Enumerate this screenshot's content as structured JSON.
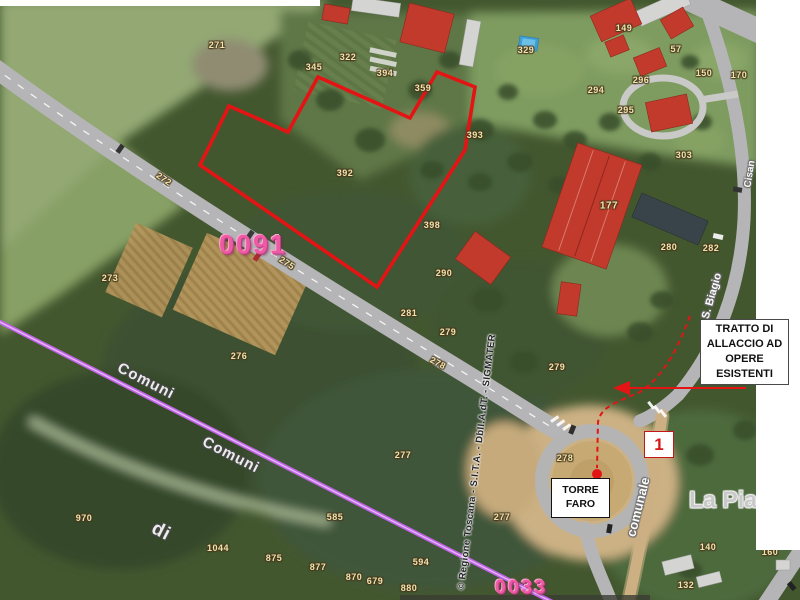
{
  "colors": {
    "parcel_text": "#f2e2ae",
    "sheet_pink": "#ee5ba4",
    "annotation_red": "#e41414",
    "boundary_purple": "#c063e6",
    "roof_red": "#c13a2c",
    "road_gray": "#b5b5b7",
    "dirt_tan": "#ccb083",
    "pool_blue": "#3f9ed3",
    "woods_green": "#43572f",
    "meadow_green": "#93a873"
  },
  "annotations": {
    "tratto_box": "TRATTO DI\nALLACCIO AD\nOPERE\nESISTENTI",
    "torre_faro_box": "TORRE\nFARO",
    "marker_1": "1"
  },
  "overlays": {
    "red_polygon_points": "229,106 288,132 318,77 410,118 437,72 475,87 465,150 377,287 200,165",
    "dashed_path": "M 690,316 C 678,348 664,376 640,392 C 618,402 601,406 598,422 L 597,468",
    "arrow": {
      "x1": 746,
      "y1": 388,
      "x2": 629,
      "y2": 388
    },
    "arrow_head": "613,388 630,381 630,395",
    "dot": {
      "cx": 597,
      "cy": 474,
      "r": 5
    },
    "purple_line": {
      "x1": -4,
      "y1": 320,
      "x2": 560,
      "y2": 606
    }
  },
  "map": {
    "labels": [
      {
        "t": "271",
        "x": 217,
        "y": 45,
        "c": "p"
      },
      {
        "t": "345",
        "x": 314,
        "y": 67,
        "c": "p"
      },
      {
        "t": "322",
        "x": 348,
        "y": 57,
        "c": "p"
      },
      {
        "t": "394",
        "x": 385,
        "y": 73,
        "c": "p"
      },
      {
        "t": "359",
        "x": 423,
        "y": 88,
        "c": "p"
      },
      {
        "t": "329",
        "x": 526,
        "y": 50,
        "c": "p"
      },
      {
        "t": "149",
        "x": 624,
        "y": 28,
        "c": "p"
      },
      {
        "t": "57",
        "x": 676,
        "y": 49,
        "c": "p"
      },
      {
        "t": "294",
        "x": 596,
        "y": 90,
        "c": "p"
      },
      {
        "t": "296",
        "x": 641,
        "y": 80,
        "c": "p"
      },
      {
        "t": "150",
        "x": 704,
        "y": 73,
        "c": "p"
      },
      {
        "t": "170",
        "x": 739,
        "y": 75,
        "c": "p"
      },
      {
        "t": "295",
        "x": 626,
        "y": 110,
        "c": "p"
      },
      {
        "t": "303",
        "x": 684,
        "y": 155,
        "c": "p"
      },
      {
        "t": "177",
        "x": 609,
        "y": 206,
        "c": "p",
        "s": 10
      },
      {
        "t": "280",
        "x": 669,
        "y": 247,
        "c": "p"
      },
      {
        "t": "282",
        "x": 711,
        "y": 248,
        "c": "p"
      },
      {
        "t": "392",
        "x": 345,
        "y": 173,
        "c": "p"
      },
      {
        "t": "393",
        "x": 475,
        "y": 135,
        "c": "p"
      },
      {
        "t": "398",
        "x": 432,
        "y": 225,
        "c": "p"
      },
      {
        "t": "290",
        "x": 444,
        "y": 273,
        "c": "p"
      },
      {
        "t": "281",
        "x": 409,
        "y": 313,
        "c": "p"
      },
      {
        "t": "279",
        "x": 448,
        "y": 332,
        "c": "p"
      },
      {
        "t": "278",
        "x": 438,
        "y": 363,
        "c": "p",
        "r": 28
      },
      {
        "t": "279",
        "x": 557,
        "y": 367,
        "c": "p"
      },
      {
        "t": "272",
        "x": 164,
        "y": 179,
        "c": "p",
        "r": 35
      },
      {
        "t": "275",
        "x": 287,
        "y": 263,
        "c": "p",
        "r": 33
      },
      {
        "t": "273",
        "x": 110,
        "y": 278,
        "c": "p"
      },
      {
        "t": "276",
        "x": 239,
        "y": 356,
        "c": "p"
      },
      {
        "t": "277",
        "x": 403,
        "y": 455,
        "c": "p"
      },
      {
        "t": "277",
        "x": 502,
        "y": 517,
        "c": "p"
      },
      {
        "t": "278",
        "x": 565,
        "y": 458,
        "c": "p"
      },
      {
        "t": "585",
        "x": 335,
        "y": 517,
        "c": "p"
      },
      {
        "t": "970",
        "x": 84,
        "y": 518,
        "c": "p"
      },
      {
        "t": "1044",
        "x": 218,
        "y": 548,
        "c": "p"
      },
      {
        "t": "875",
        "x": 274,
        "y": 558,
        "c": "p"
      },
      {
        "t": "877",
        "x": 318,
        "y": 567,
        "c": "p"
      },
      {
        "t": "870",
        "x": 354,
        "y": 577,
        "c": "p"
      },
      {
        "t": "679",
        "x": 375,
        "y": 581,
        "c": "p"
      },
      {
        "t": "880",
        "x": 409,
        "y": 588,
        "c": "p"
      },
      {
        "t": "594",
        "x": 421,
        "y": 562,
        "c": "p"
      },
      {
        "t": "140",
        "x": 708,
        "y": 547,
        "c": "p"
      },
      {
        "t": "132",
        "x": 686,
        "y": 585,
        "c": "p"
      },
      {
        "t": "160",
        "x": 770,
        "y": 552,
        "c": "p"
      },
      {
        "t": "0091",
        "x": 253,
        "y": 245,
        "c": "sh",
        "s": 27
      },
      {
        "t": "0033",
        "x": 521,
        "y": 588,
        "c": "sh",
        "s": 20
      },
      {
        "t": "Comuni",
        "x": 146,
        "y": 381,
        "c": "b",
        "r": 27
      },
      {
        "t": "Comuni",
        "x": 231,
        "y": 455,
        "c": "b",
        "r": 27
      },
      {
        "t": "di",
        "x": 161,
        "y": 532,
        "c": "b",
        "r": 27,
        "s": 19
      },
      {
        "t": "S. Biagio",
        "x": 712,
        "y": 296,
        "c": "rn",
        "r": -74
      },
      {
        "t": "Cisan",
        "x": 750,
        "y": 174,
        "c": "rn",
        "r": -81,
        "s": 10
      },
      {
        "t": "comunale",
        "x": 638,
        "y": 507,
        "c": "rn",
        "r": -76,
        "s": 13
      },
      {
        "t": "La Pia",
        "x": 723,
        "y": 500,
        "c": "pl"
      },
      {
        "t": "© Regione Toscana - S.I.T.A. - DbII.A.dT. - SIGMATER",
        "x": 477,
        "y": 462,
        "c": "wm",
        "r": -83
      }
    ]
  }
}
